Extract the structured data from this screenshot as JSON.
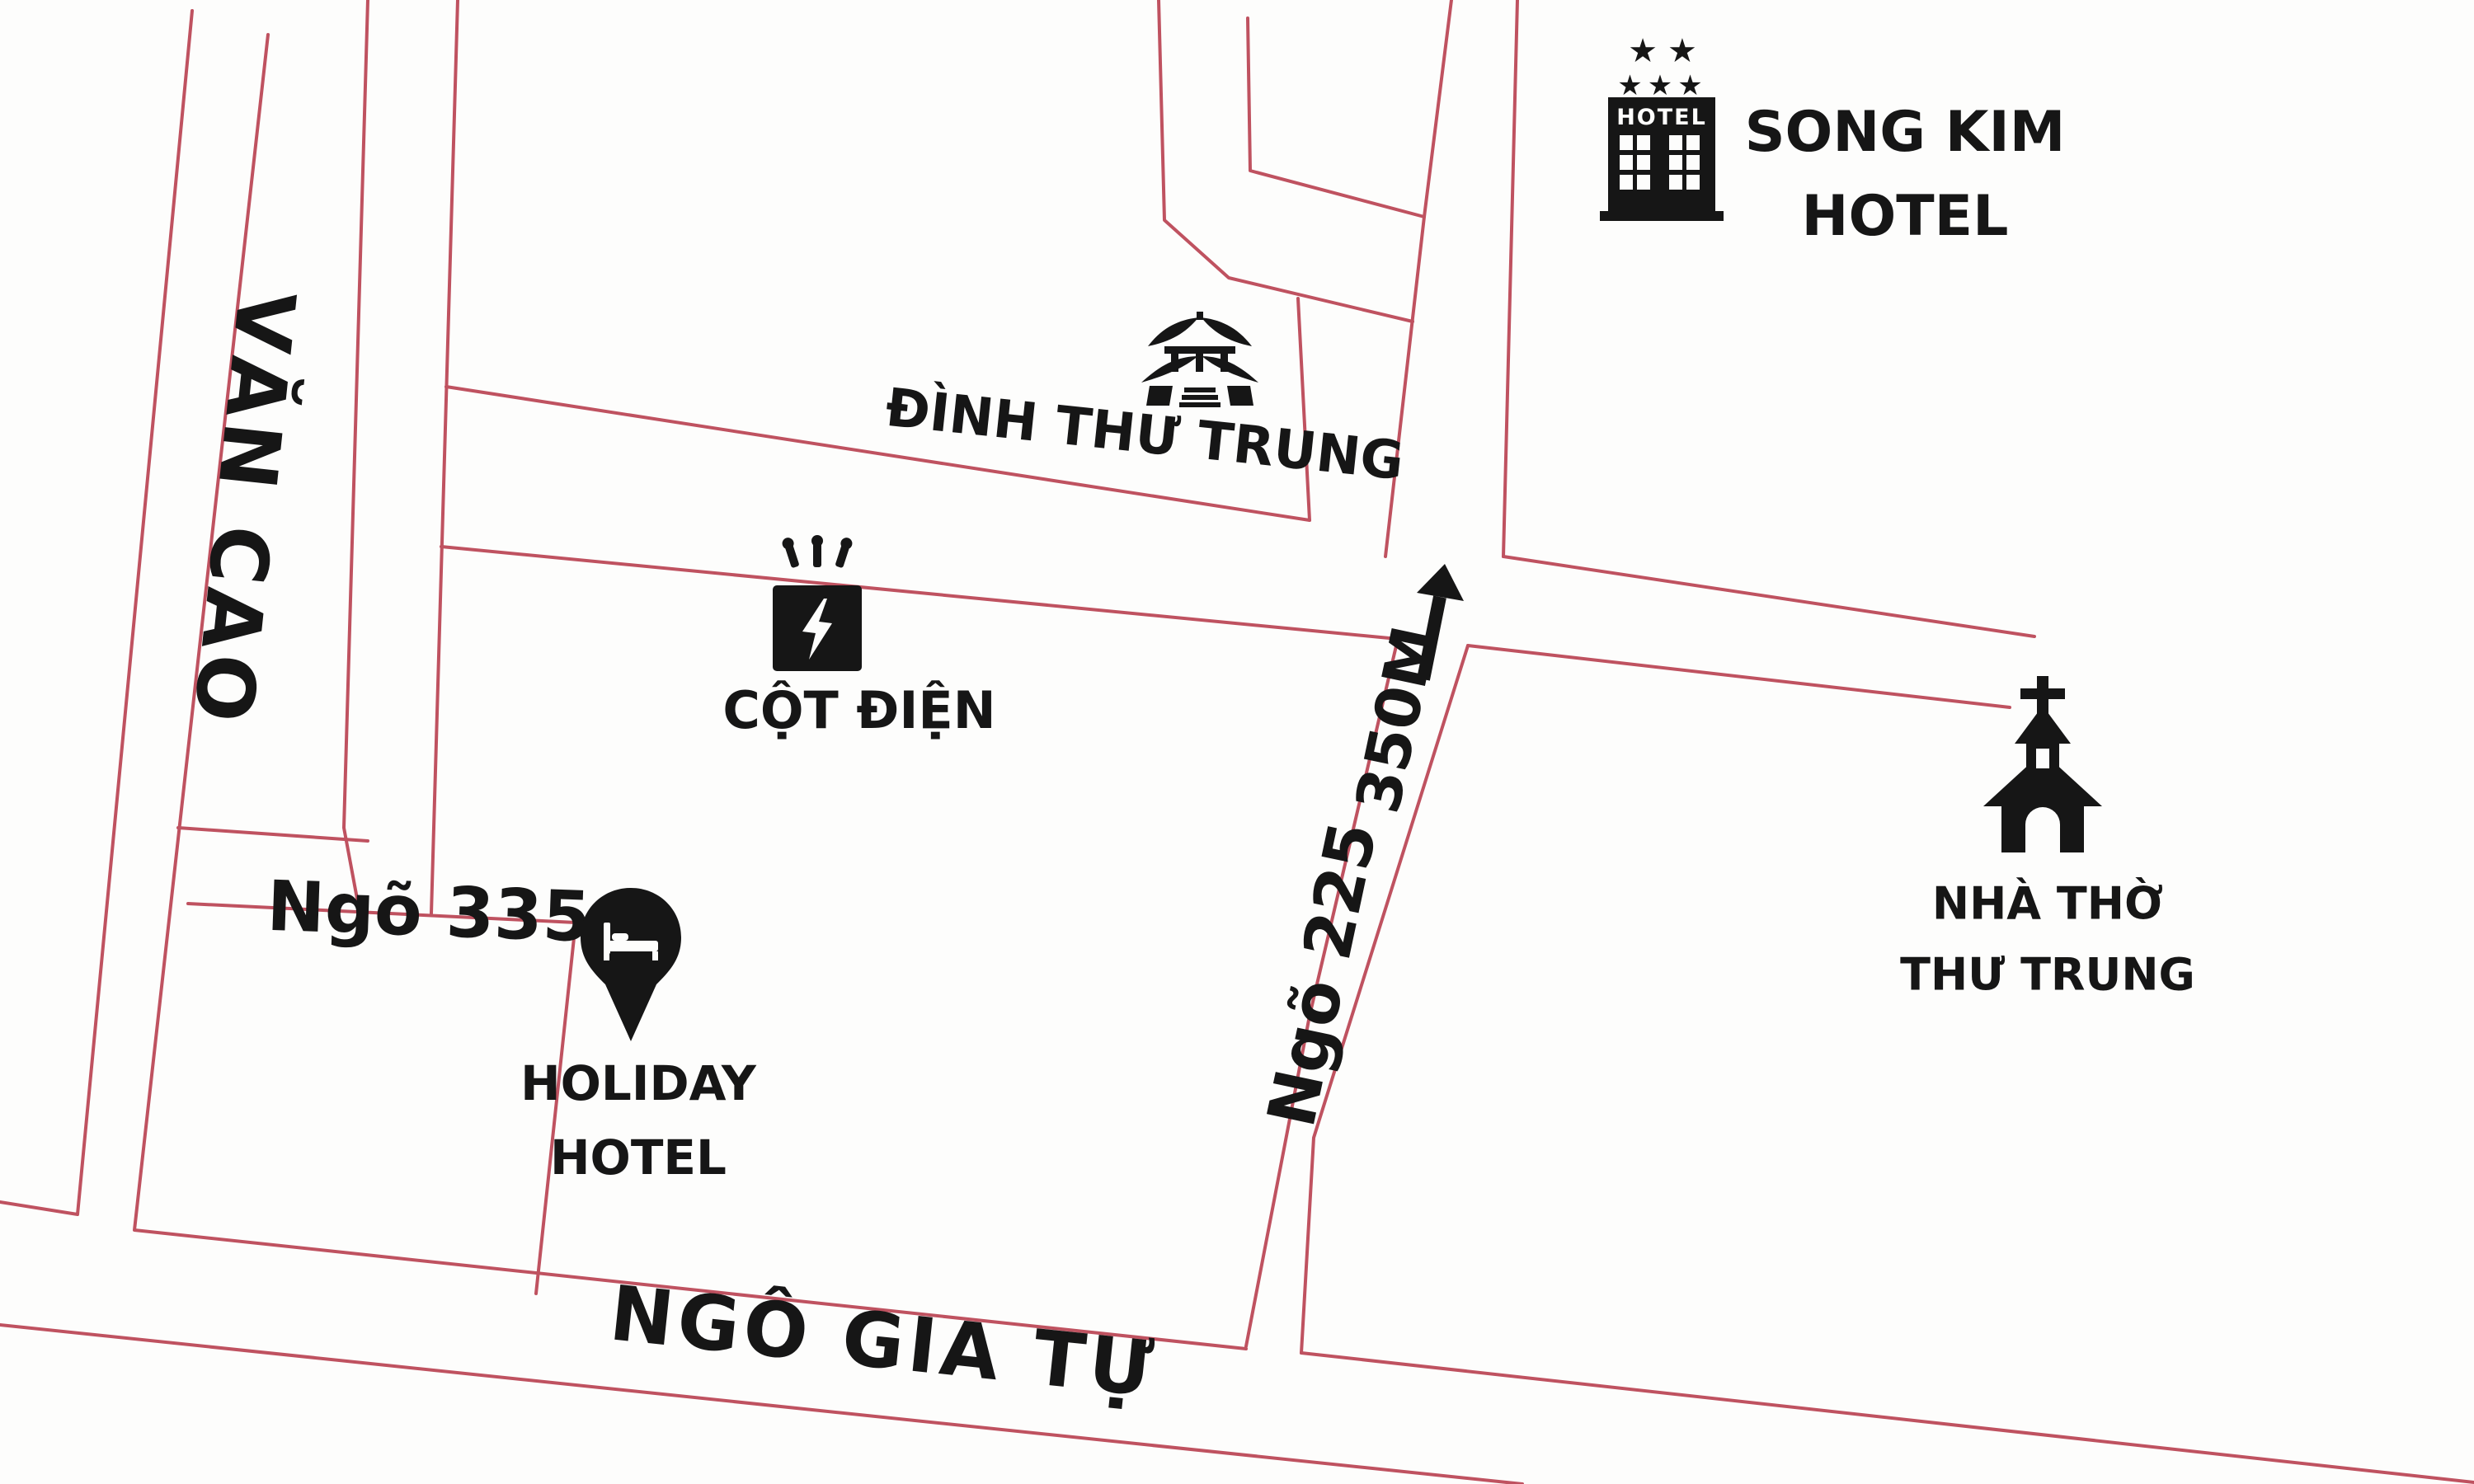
{
  "map": {
    "background": "#fdfdfc",
    "road_color": "#bf5260",
    "ink_color": "#161616"
  },
  "labels": {
    "van_cao": "VĂN CAO",
    "ngo_335": "Ngõ 335",
    "holiday_line1": "HOLIDAY",
    "holiday_line2": "HOTEL",
    "cot_dien": "CỘT ĐIỆN",
    "dinh_thu_trung": "ĐÌNH THƯ TRUNG",
    "song_kim_line1": "SONG KIM",
    "song_kim_line2": "HOTEL",
    "hotel_sign": "HOTEL",
    "stars_row1": "★★",
    "stars_row2": "★★★",
    "ngo_225": "Ngõ 225",
    "distance_350m": "350M",
    "nha_tho_line1": "NHÀ THỜ",
    "nha_tho_line2": "THƯ TRUNG",
    "ngo_gia_tu": "NGÔ GIA TỰ"
  },
  "roads": [
    {
      "name": "road-van-cao-left",
      "points": [
        [
          233,
          13
        ],
        [
          94,
          1473
        ],
        [
          0,
          1458
        ]
      ]
    },
    {
      "name": "road-van-cao-right-ngo-gia-tu-upper",
      "points": [
        [
          325,
          42
        ],
        [
          163,
          1492
        ],
        [
          1511,
          1636
        ]
      ]
    },
    {
      "name": "road-ngo-gia-tu-upper-east",
      "points": [
        [
          1578,
          1641
        ],
        [
          3000,
          1798
        ]
      ]
    },
    {
      "name": "road-ngo-gia-tu-lower",
      "points": [
        [
          0,
          1607
        ],
        [
          1846,
          1800
        ]
      ]
    },
    {
      "name": "road-ngo-335-upper",
      "points": [
        [
          216,
          1004
        ],
        [
          446,
          1020
        ]
      ]
    },
    {
      "name": "road-ngo-335-lower-block",
      "points": [
        [
          228,
          1096
        ],
        [
          698,
          1119
        ],
        [
          650,
          1569
        ]
      ]
    },
    {
      "name": "road-alley-left",
      "points": [
        [
          446,
          0
        ],
        [
          417,
          1004
        ],
        [
          436,
          1106
        ]
      ]
    },
    {
      "name": "road-alley-right",
      "points": [
        [
          555,
          0
        ],
        [
          523,
          1108
        ]
      ]
    },
    {
      "name": "road-temple-block-west",
      "points": [
        [
          1405,
          0
        ],
        [
          1412,
          267
        ],
        [
          1490,
          337
        ],
        [
          1713,
          390
        ]
      ]
    },
    {
      "name": "road-temple-block-right",
      "points": [
        [
          1574,
          362
        ],
        [
          1588,
          631
        ]
      ]
    },
    {
      "name": "road-temple-block-bottom",
      "points": [
        [
          541,
          469
        ],
        [
          1588,
          631
        ]
      ]
    },
    {
      "name": "road-mid-block-line",
      "points": [
        [
          1513,
          22
        ],
        [
          1516,
          207
        ],
        [
          1727,
          263
        ]
      ]
    },
    {
      "name": "road-cot-dien-street-lower",
      "points": [
        [
          535,
          663
        ],
        [
          1695,
          775
        ]
      ]
    },
    {
      "name": "road-church-street-lower",
      "points": [
        [
          1780,
          783
        ],
        [
          2437,
          858
        ]
      ]
    },
    {
      "name": "road-church-street-upper",
      "points": [
        [
          1823,
          675
        ],
        [
          2467,
          772
        ]
      ]
    },
    {
      "name": "road-ngo-225-left-top",
      "points": [
        [
          1760,
          0
        ],
        [
          1727,
          263
        ],
        [
          1680,
          675
        ]
      ]
    },
    {
      "name": "road-ngo-225-right-top",
      "points": [
        [
          1840,
          0
        ],
        [
          1823,
          675
        ]
      ]
    },
    {
      "name": "road-ngo-225-left-bottom",
      "points": [
        [
          1695,
          775
        ],
        [
          1588,
          1232
        ],
        [
          1511,
          1633
        ]
      ]
    },
    {
      "name": "road-ngo-225-right-bottom",
      "points": [
        [
          1780,
          783
        ],
        [
          1593,
          1380
        ],
        [
          1578,
          1641
        ]
      ]
    }
  ]
}
